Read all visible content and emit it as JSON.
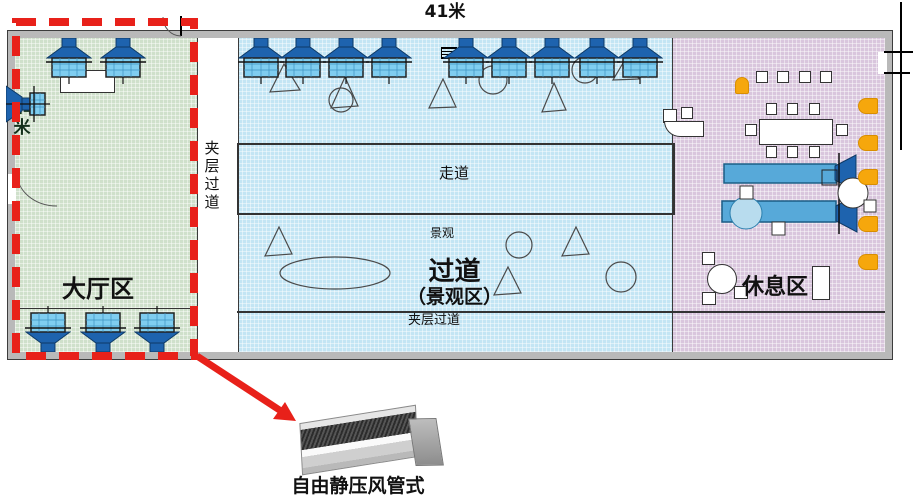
{
  "plan": {
    "dimension_top": "41米",
    "dimension_left": "14米",
    "zones": {
      "lobby": {
        "label": "大厅区",
        "color": "#cfe0cb"
      },
      "corridor": {
        "label": "过道",
        "sublabel": "（景观区）",
        "color": "#c3e5f4"
      },
      "rest": {
        "label": "休息区",
        "color": "#d9c6dd"
      }
    },
    "strips": {
      "mezzanine_left": "夹层过道",
      "mezzanine_bottom": "夹层过道",
      "walkway": "走道",
      "scenic": "景观"
    },
    "colors": {
      "highlight_red": "#e8211a",
      "diffuser_blue": "#1e63ae",
      "grille_blue": "#7fcdf0",
      "duct_blue": "#57a9d9",
      "chair_orange": "#f6a70c"
    }
  },
  "callout": {
    "caption": "自由静压风管式"
  }
}
